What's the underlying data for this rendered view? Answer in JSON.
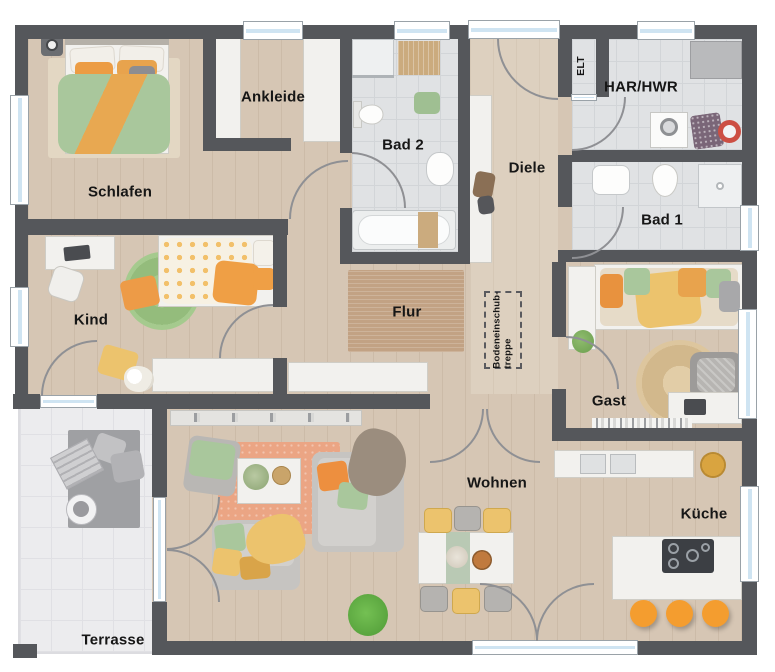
{
  "plan_type": "floor-plan",
  "labels": {
    "schlafen": "Schlafen",
    "ankleide": "Ankleide",
    "bad2": "Bad 2",
    "diele": "Diele",
    "elt": "ELT",
    "har": "HAR/HWR",
    "bad1": "Bad 1",
    "kind": "Kind",
    "flur": "Flur",
    "treppe_line1": "Bodeneinschub-",
    "treppe_line2": "treppe",
    "gast": "Gast",
    "wohnen": "Wohnen",
    "kueche": "Küche",
    "terrasse": "Terrasse"
  },
  "colors": {
    "wall": "#55575b",
    "wood_floor": "#d6c6b4",
    "wood_floor_light": "#ddd0bf",
    "bath_tile": "#e0e2e4",
    "bath_tile_line": "#d2d5d8",
    "terrace": "#ececee",
    "terrace_line": "#e0e0e4",
    "window_glass": "#cfe4f2",
    "door_arc": "#8f9094",
    "furniture_white": "#f2f1ee",
    "sofa_gray": "#c6c4c1",
    "flur_rug": "#c2a284",
    "salmon_rug": "#eba584",
    "kind_rug": "#9ec487",
    "jute_rug": "#dcc49c",
    "accent_orange": "#ec9c44",
    "accent_green": "#a9c79c",
    "accent_yellow": "#ecc36d",
    "stool_orange": "#f49d2f",
    "cooktop": "#3c3f44"
  }
}
